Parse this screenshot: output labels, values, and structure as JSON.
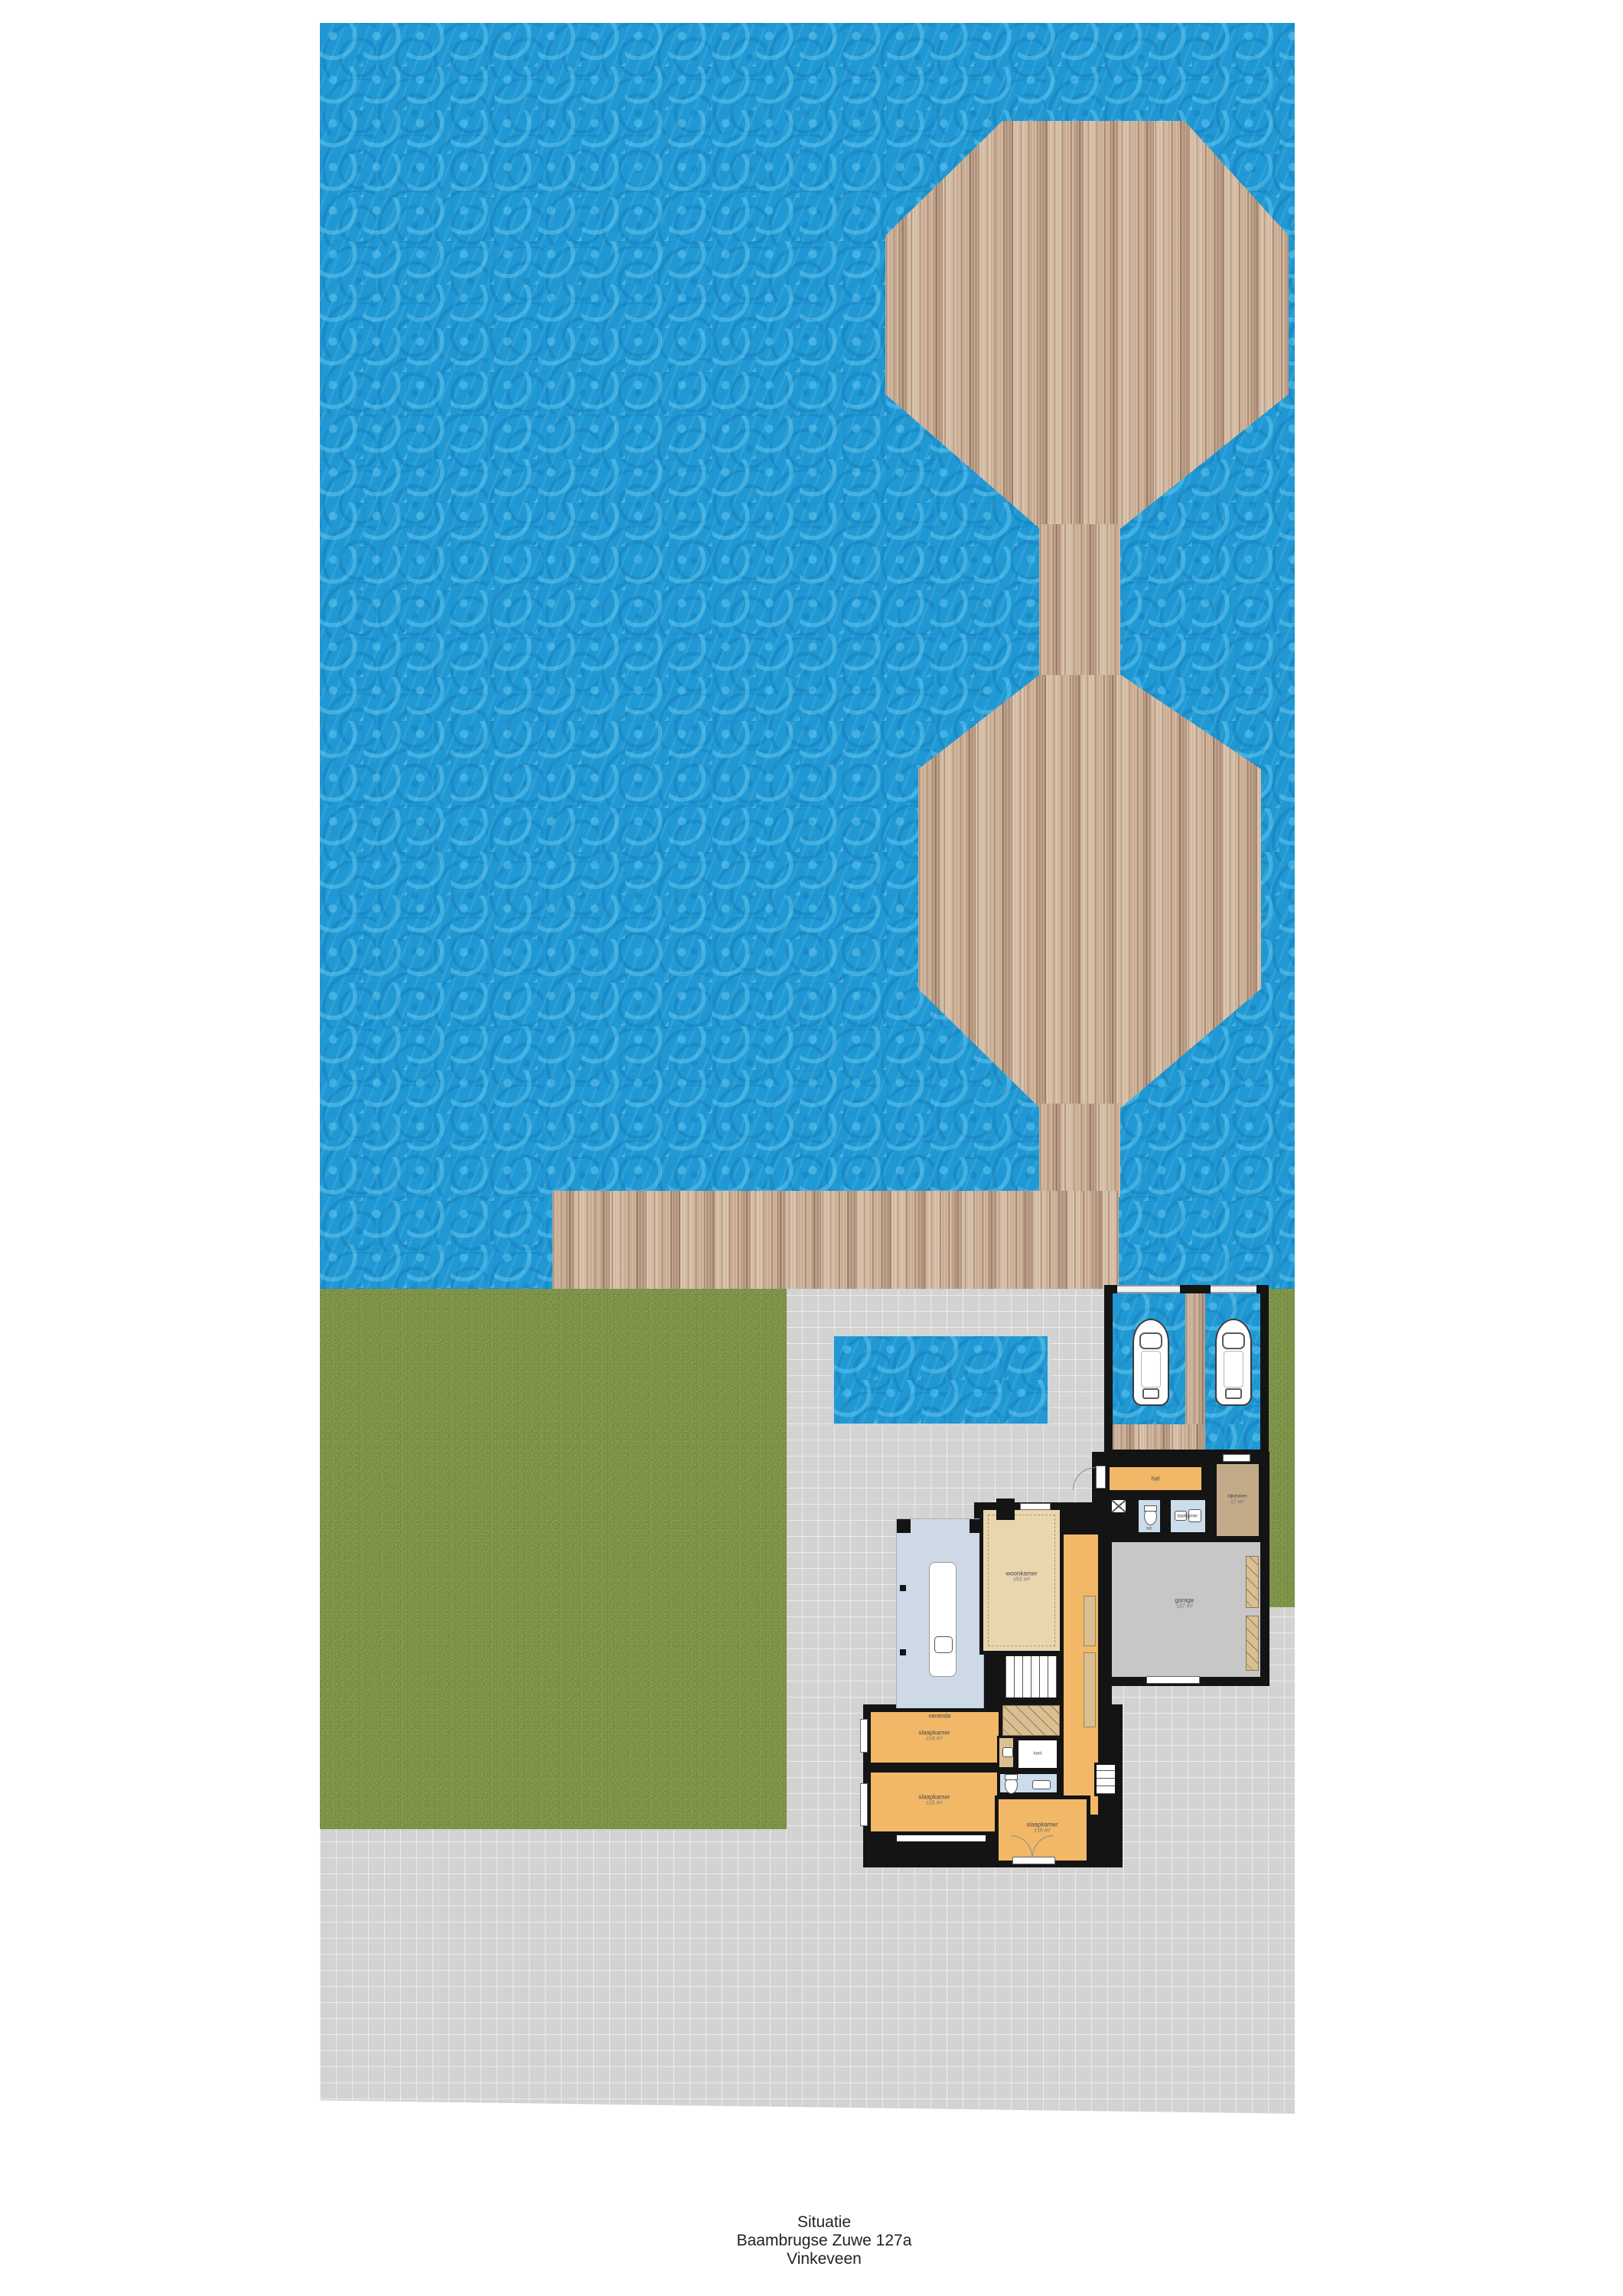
{
  "caption": {
    "line1": "Situatie",
    "line2": "Baambrugse Zuwe 127a",
    "line3": "Vinkeveen"
  },
  "rooms": {
    "hal": {
      "label": "hal"
    },
    "wc": {
      "label": "wc"
    },
    "badkamer": {
      "label": "badkamer"
    },
    "bijkeuken": {
      "label": "bijkeuken",
      "size": "±7 m²"
    },
    "garage": {
      "label": "garage",
      "size": "±37 m²"
    },
    "veranda": {
      "label": "veranda"
    },
    "woonkamer": {
      "label": "woonkamer",
      "size": "±52 m²"
    },
    "slaapkamer_1": {
      "label": "slaapkamer",
      "size": "±14 m²"
    },
    "slaapkamer_2": {
      "label": "slaapkamer",
      "size": "±15 m²"
    },
    "slaapkamer_3": {
      "label": "slaapkamer",
      "size": "±16 m²"
    },
    "kast": {
      "label": "kast"
    }
  },
  "boathouse": {
    "boat_count": 2
  },
  "colors": {
    "water": "#1f98d4",
    "water_highlight": "#54b9e6",
    "wood": "#bfa186",
    "wood_dark": "#a88a72",
    "grass": "#7e9447",
    "paving": "#d4d4d4",
    "wall": "#141414",
    "room_orange": "#f2b868",
    "room_tan": "#e9d5ae",
    "room_gray": "#c7c7c7",
    "room_blue": "#cbdceb",
    "room_brown": "#c3ab8a",
    "room_veranda": "#cdd9e6"
  }
}
